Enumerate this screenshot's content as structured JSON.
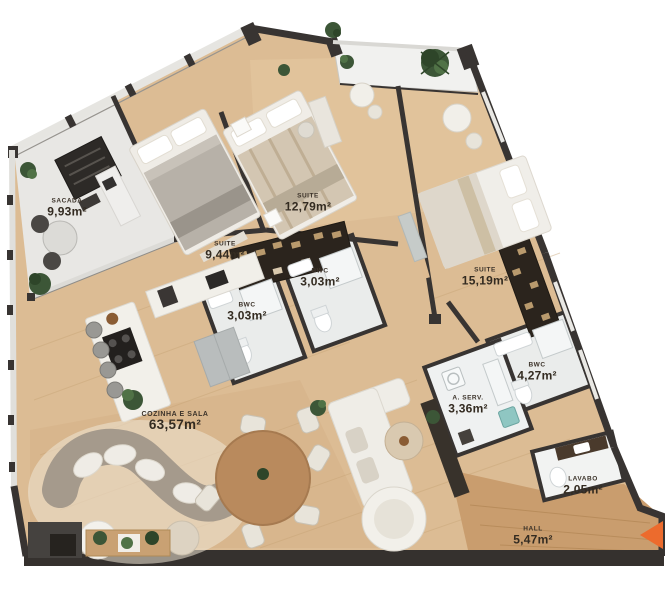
{
  "plan": {
    "type": "apartment-floor-plan",
    "rooms": [
      {
        "id": "sacada",
        "name": "SACADA",
        "area": "9,93m²"
      },
      {
        "id": "suite-944",
        "name": "SUITE",
        "area": "9,44m²"
      },
      {
        "id": "suite-1279",
        "name": "SUITE",
        "area": "12,79m²"
      },
      {
        "id": "bwc-left",
        "name": "BWC",
        "area": "3,03m²"
      },
      {
        "id": "bwc-right",
        "name": "BWC",
        "area": "3,03m²"
      },
      {
        "id": "suite-1519",
        "name": "SUITE",
        "area": "15,19m²"
      },
      {
        "id": "bwc-427",
        "name": "BWC",
        "area": "4,27m²"
      },
      {
        "id": "area-servico",
        "name": "A. SERV.",
        "area": "3,36m²"
      },
      {
        "id": "cozinha-sala",
        "name": "COZINHA E SALA",
        "area": "63,57m²"
      },
      {
        "id": "lavabo",
        "name": "LAVABO",
        "area": "2,05m²"
      },
      {
        "id": "hall",
        "name": "HALL",
        "area": "5,47m²"
      }
    ],
    "colors": {
      "wall": "#383432",
      "wood_floor": "#dcbc94",
      "hall_floor": "#c99d6e",
      "tile_floor": "#eaeceb",
      "balcony_floor": "#e8e7e4",
      "plant": "#3c5637",
      "entrance_marker": "#ec6b2d",
      "background": "#ffffff"
    }
  }
}
